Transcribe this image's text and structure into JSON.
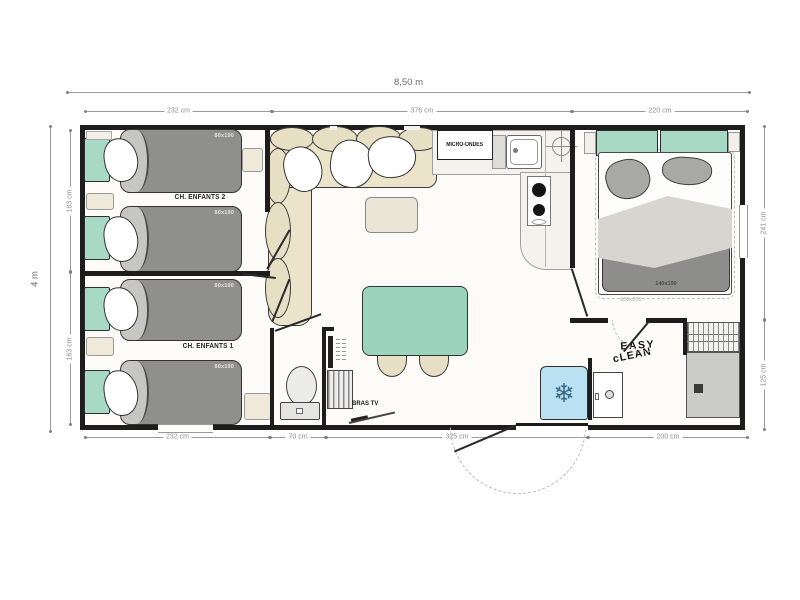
{
  "floorplan": {
    "type": "mobile-home floor plan, 3 bedrooms",
    "dims": {
      "width_total": "8,50 m",
      "height_total": "4 m",
      "top": [
        "232 cm",
        "376 cm",
        "220 cm"
      ],
      "left": [
        "183 cm",
        "183 cm"
      ],
      "right": [
        "241 cm",
        "125 cm"
      ],
      "bottom": [
        "232 cm",
        "70 cm",
        "325 cm",
        "200 cm"
      ]
    },
    "labels": {
      "kids_room_2": "CH. ENFANTS 2",
      "kids_room_1": "CH. ENFANTS 1",
      "bed_single": "80x190",
      "bed_double": "140x190",
      "bed_double_option": "160x200",
      "microwave": "MICRO-ONDES",
      "tv_arm": "BRAS TV",
      "brand_line_1": "EASY",
      "brand_line_2": "cLEAN"
    },
    "icons": {
      "fridge_snowflake": "❄"
    },
    "colors": {
      "wall": "#1d1d1d",
      "mint_green": "#a7d9c4",
      "table_green": "#9bd4bd",
      "mattress_gray": "#8f8f8d",
      "sofa_beige": "#ece4ca",
      "fridge_blue": "#b9e1f1",
      "shower_gray": "#cbcbc8",
      "dimension_gray": "#8f8f8f"
    }
  }
}
